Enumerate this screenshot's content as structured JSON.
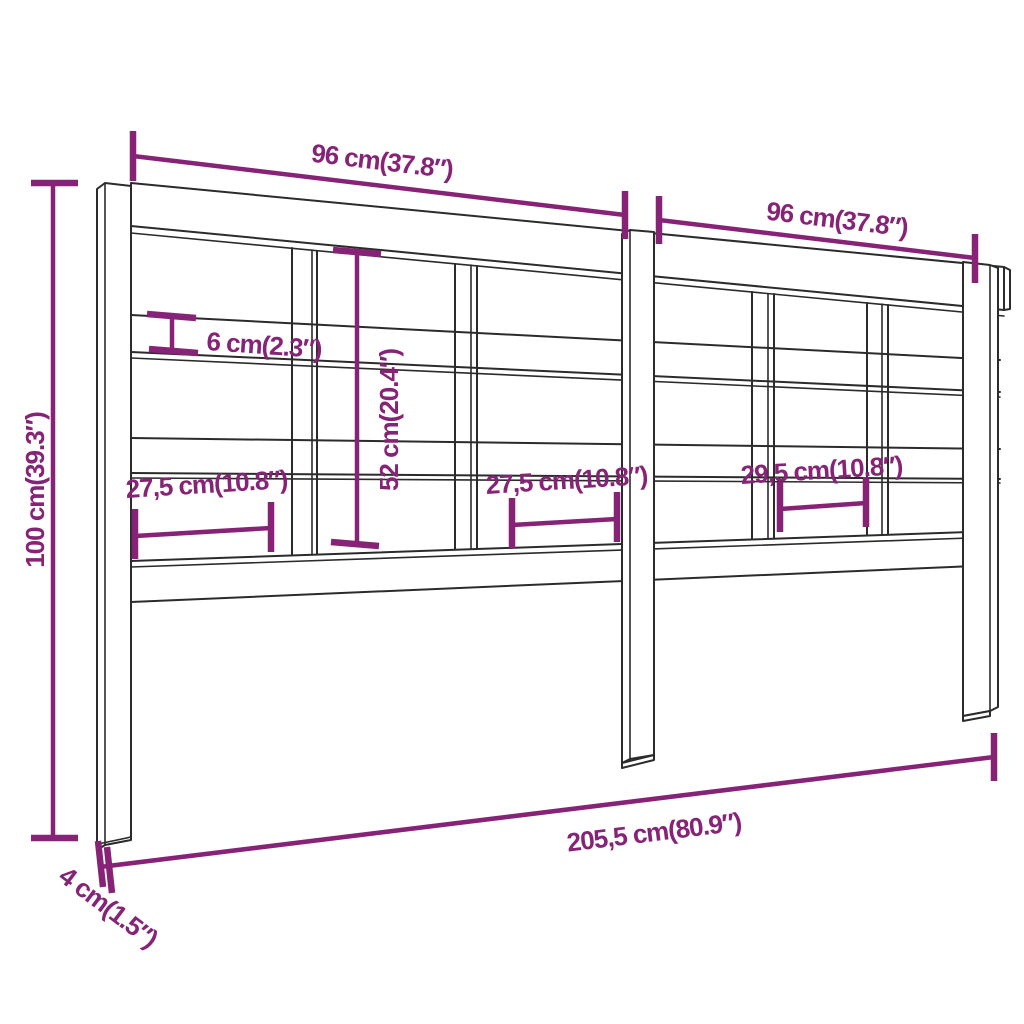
{
  "title": "Headboard dimension diagram",
  "colors": {
    "dimension_accent": "#872377",
    "outline": "#2b2b2b",
    "background": "#ffffff"
  },
  "dims": {
    "total_height": {
      "label": "100 cm(39.3″)"
    },
    "top_width_left": {
      "label": "96 cm(37.8″)"
    },
    "top_width_right": {
      "label": "96 cm(37.8″)"
    },
    "rail_thickness": {
      "label": "6 cm(2.3″)"
    },
    "inner_height": {
      "label": "52 cm(20.4″)"
    },
    "section_width_1": {
      "label": "27,5 cm(10.8″)"
    },
    "section_width_2": {
      "label": "27,5 cm(10.8″)"
    },
    "section_width_3": {
      "label": "29,5 cm(10.8″)"
    },
    "total_width": {
      "label": "205,5 cm(80.9″)"
    },
    "leg_thickness": {
      "label": "4 cm(1.5″)"
    }
  }
}
